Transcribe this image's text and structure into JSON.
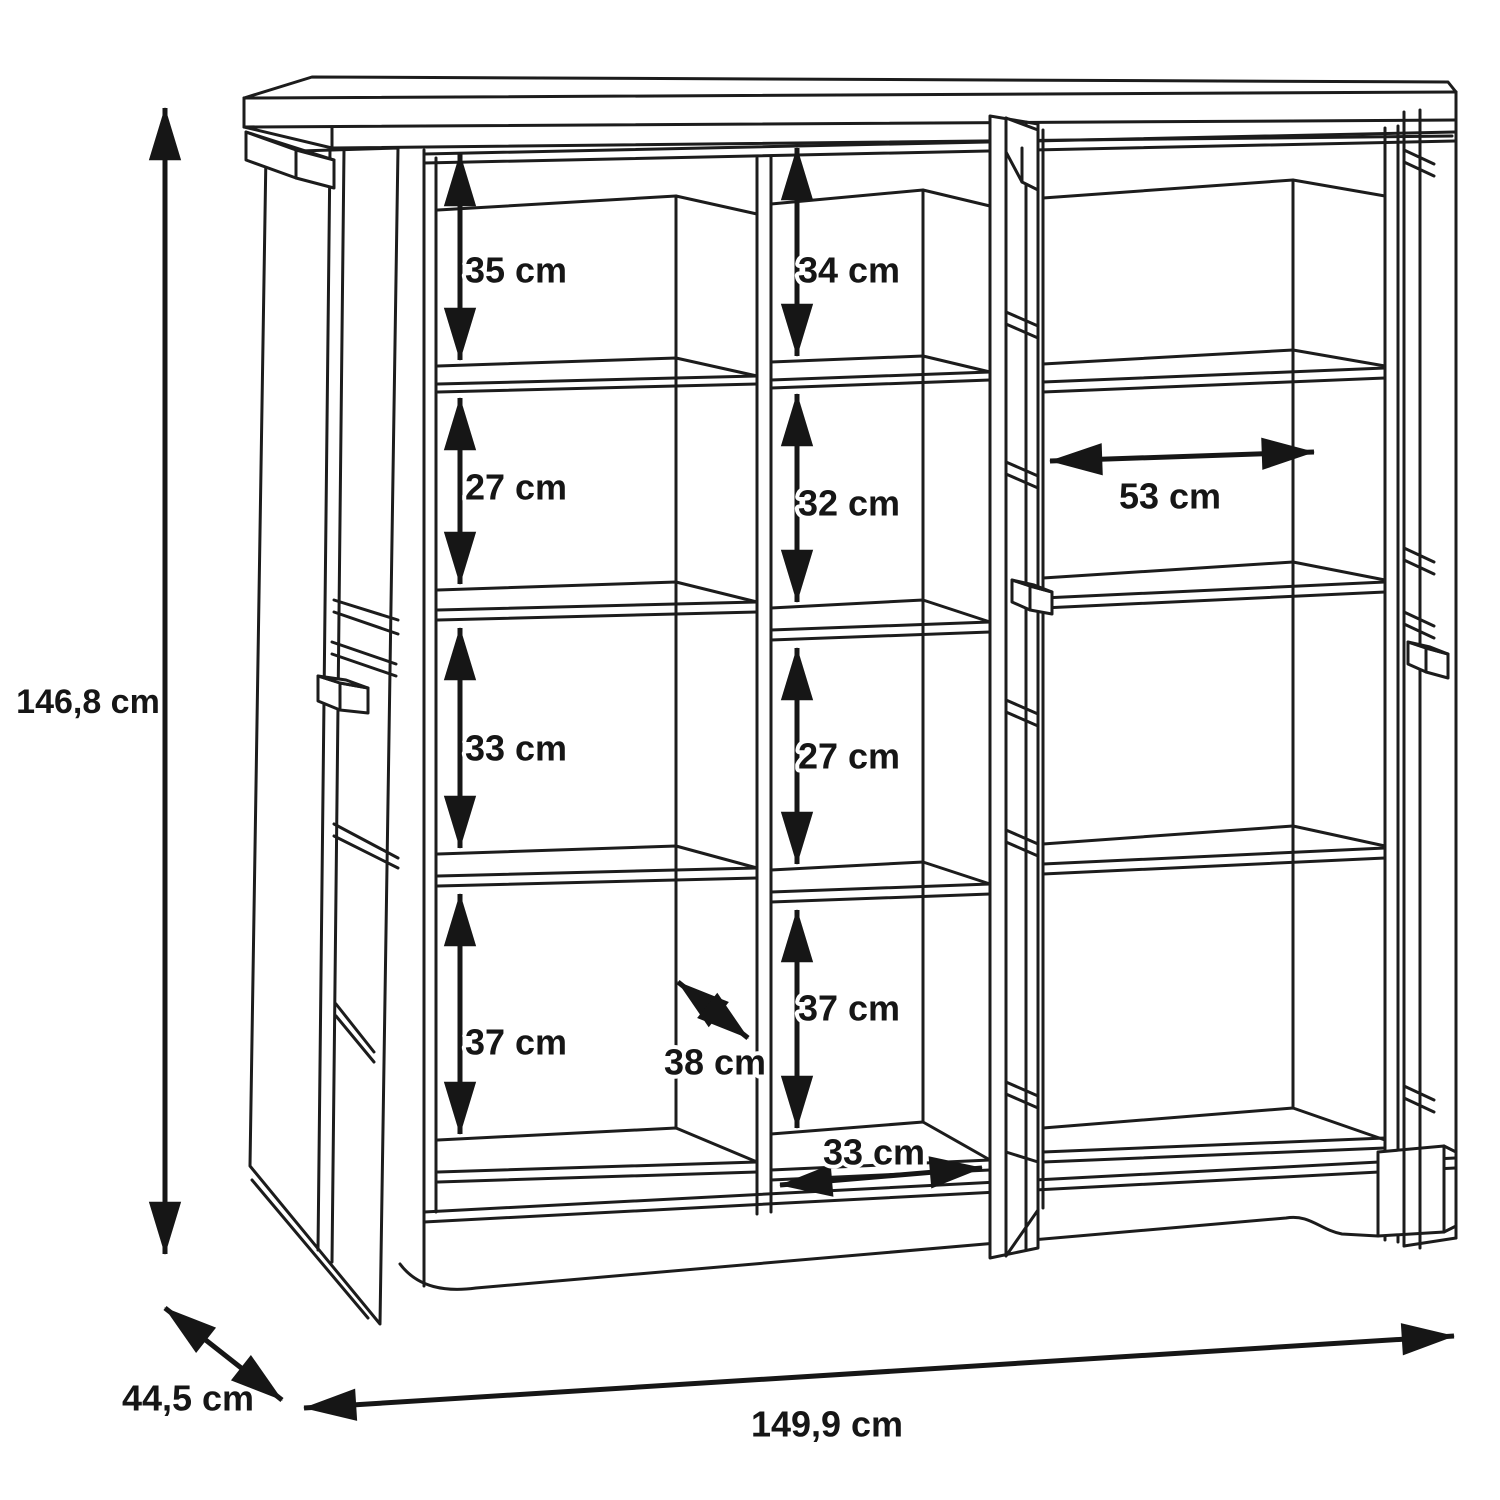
{
  "labels": {
    "overall_height": "146,8 cm",
    "overall_depth": "44,5 cm",
    "overall_width": "149,9 cm",
    "left_column": [
      "35 cm",
      "27 cm",
      "33 cm",
      "37 cm"
    ],
    "middle_column": [
      "34 cm",
      "32 cm",
      "27 cm",
      "37 cm"
    ],
    "right_section_width": "53 cm",
    "inner_depth": "38 cm",
    "inner_bottom_width": "33 cm"
  },
  "colors": {
    "line": "#1c1c1c",
    "dimension": "#161616",
    "background": "#ffffff"
  }
}
